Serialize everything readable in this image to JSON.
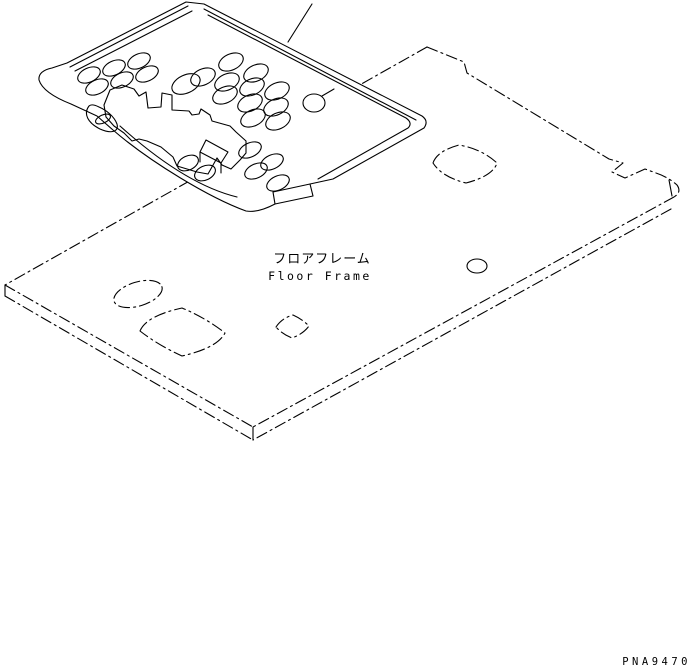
{
  "page": {
    "background_color": "#ffffff",
    "line_color": "#000000"
  },
  "labels": {
    "part_name_jp": "フロアフレーム",
    "part_name_en": "Floor Frame",
    "drawing_number": "PNA9470"
  }
}
